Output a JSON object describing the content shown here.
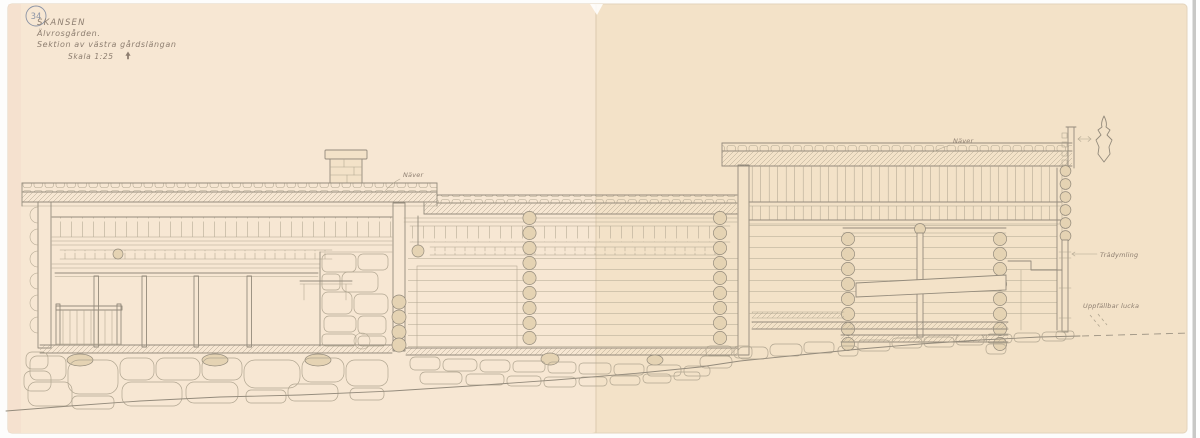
{
  "document": {
    "sheet_number": "34",
    "title": "SKANSEN",
    "subtitle": "Älvrosgården.",
    "description": "Sektion av västra gårdslängan",
    "scale": "Skala 1:25"
  },
  "annotations": {
    "roof_material_left": "Näver",
    "roof_material_right": "Näver",
    "wall_dowel": "Trädymling",
    "hatch_note": "Uppfällbar lucka"
  },
  "colors": {
    "paper_left": "#f7e7d3",
    "paper_right": "#f3e2c8",
    "paper_edge": "#e3d4bc",
    "seam": "#e0cfb4",
    "pencil": "#948b7c",
    "pencil_light": "#b0a590",
    "wood_shade": "#e5d3b3",
    "text_ink": "#8d7e70",
    "badge_ink": "#8b94a6",
    "scan_band": "#c9c9c7"
  }
}
